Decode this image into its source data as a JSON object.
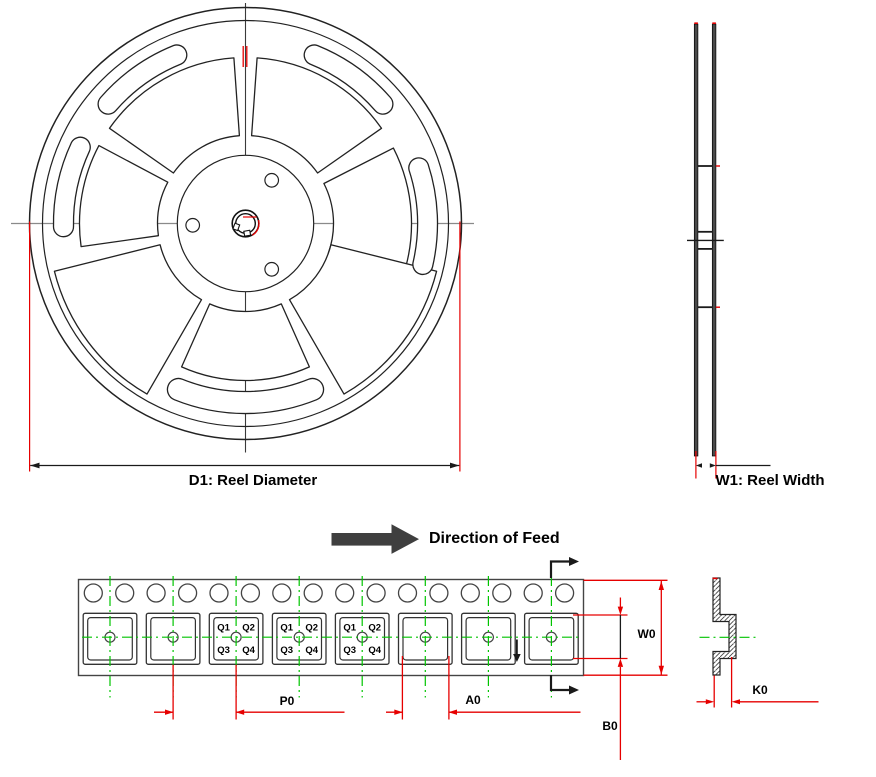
{
  "labels": {
    "d1": "D1: Reel Diameter",
    "w1": "W1: Reel Width",
    "direction_of_feed": "Direction of Feed",
    "p0": "P0",
    "a0": "A0",
    "w0": "W0",
    "b0": "B0",
    "k0": "K0"
  },
  "tape": {
    "sprocket_hole_count": 16,
    "pocket_count": 8,
    "pockets_with_quadrant_labels": [
      3,
      4,
      5
    ],
    "quadrant_labels": [
      "Q1",
      "Q2",
      "Q3",
      "Q4"
    ]
  },
  "colors": {
    "dimension_red": "#e60000",
    "centerline_green": "#00c400",
    "drawing_black": "#1a1a1a",
    "feed_arrow_gray": "#3f3f3f"
  }
}
